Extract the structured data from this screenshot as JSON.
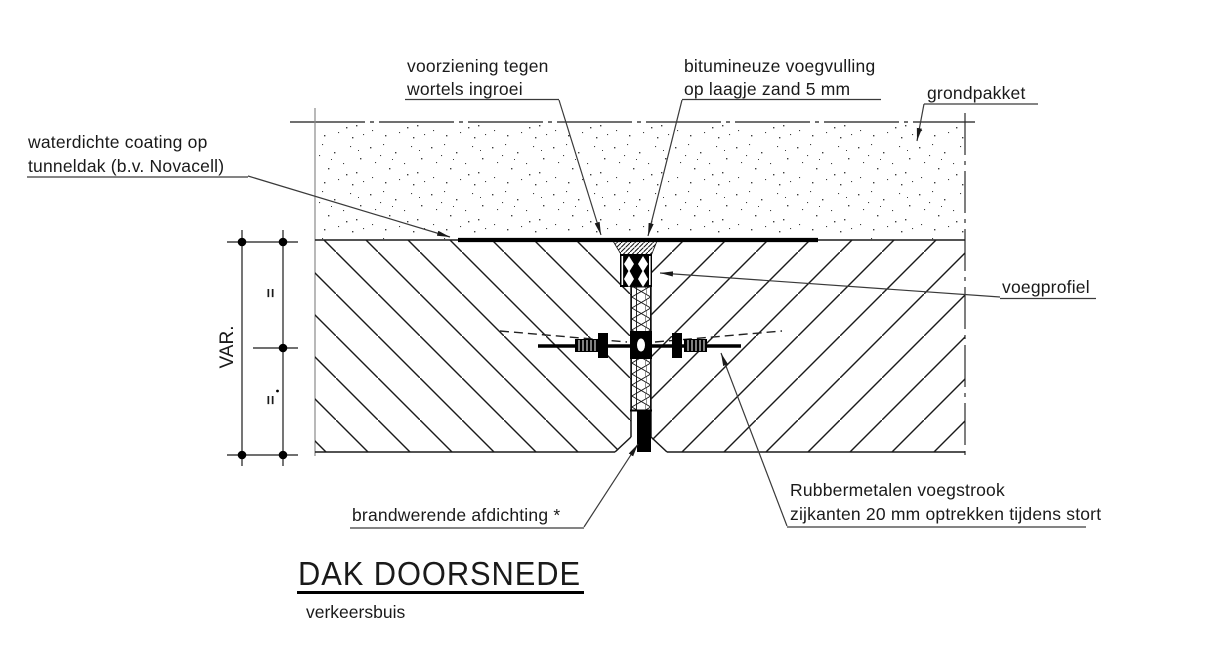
{
  "title": {
    "text": "DAK DOORSNEDE",
    "subtitle": "verkeersbuis"
  },
  "labels": {
    "root_barrier": {
      "line1": "voorziening tegen",
      "line2": "wortels ingroei"
    },
    "bitumen": {
      "line1": "bitumineuze voegvulling",
      "line2": "op laagje zand 5 mm"
    },
    "ground": {
      "text": "grondpakket"
    },
    "coating": {
      "line1": "waterdichte coating op",
      "line2": "tunneldak (b.v. Novacell)"
    },
    "joint_profile": {
      "text": "voegprofiel"
    },
    "fire_seal": {
      "text": "brandwerende afdichting *"
    },
    "rubber_strip": {
      "line1": "Rubbermetalen voegstrook",
      "line2": "zijkanten 20 mm optrekken tijdens stort"
    }
  },
  "dimension": {
    "var_label": "VAR.",
    "equal_mark_top": "=",
    "equal_mark_bottom": "="
  },
  "colors": {
    "line": "#1a1a1a",
    "leader": "#3a3a3a",
    "background": "#ffffff"
  }
}
